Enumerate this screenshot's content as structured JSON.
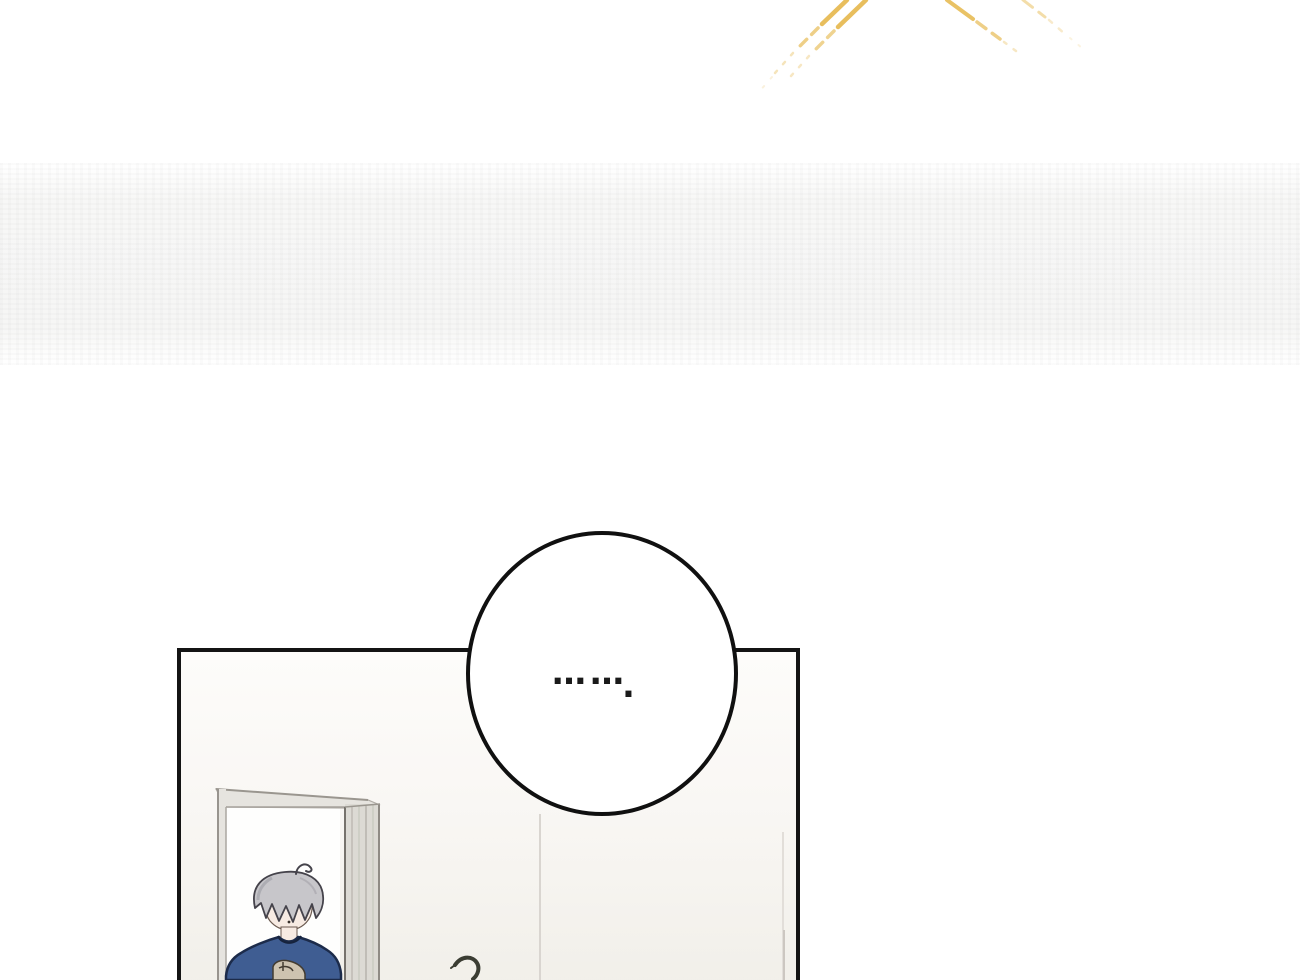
{
  "scene": {
    "description": "Webtoon comic panel: a gray-haired character in a navy sweater stands in a doorway; a silent round speech bubble sits on the panel's top edge; golden light rays shine at the top of the page",
    "bubble": {
      "ellipsis": "……",
      "period": "."
    },
    "colors": {
      "page_background": "#ffffff",
      "panel_border": "#141414",
      "bubble_border": "#101010",
      "rays": "#e7bb54",
      "wall_top": "#fdfcfa",
      "wall_bottom": "#f1efe9",
      "door_opening": "#fefefd",
      "frame_fill": "#e6e4df",
      "frame_side": "#dcdad4",
      "frame_line": "#8f8b85",
      "hair": "#c7c6ca",
      "hair_shadow": "#a3a2a9",
      "skin": "#f7ebe3",
      "shirt": "#3f5d92",
      "shirt_outline": "#1c2b4a",
      "sweater_print": "#cdc3b0",
      "plant": "#3b3d33",
      "text": "#1a1a1a"
    }
  }
}
